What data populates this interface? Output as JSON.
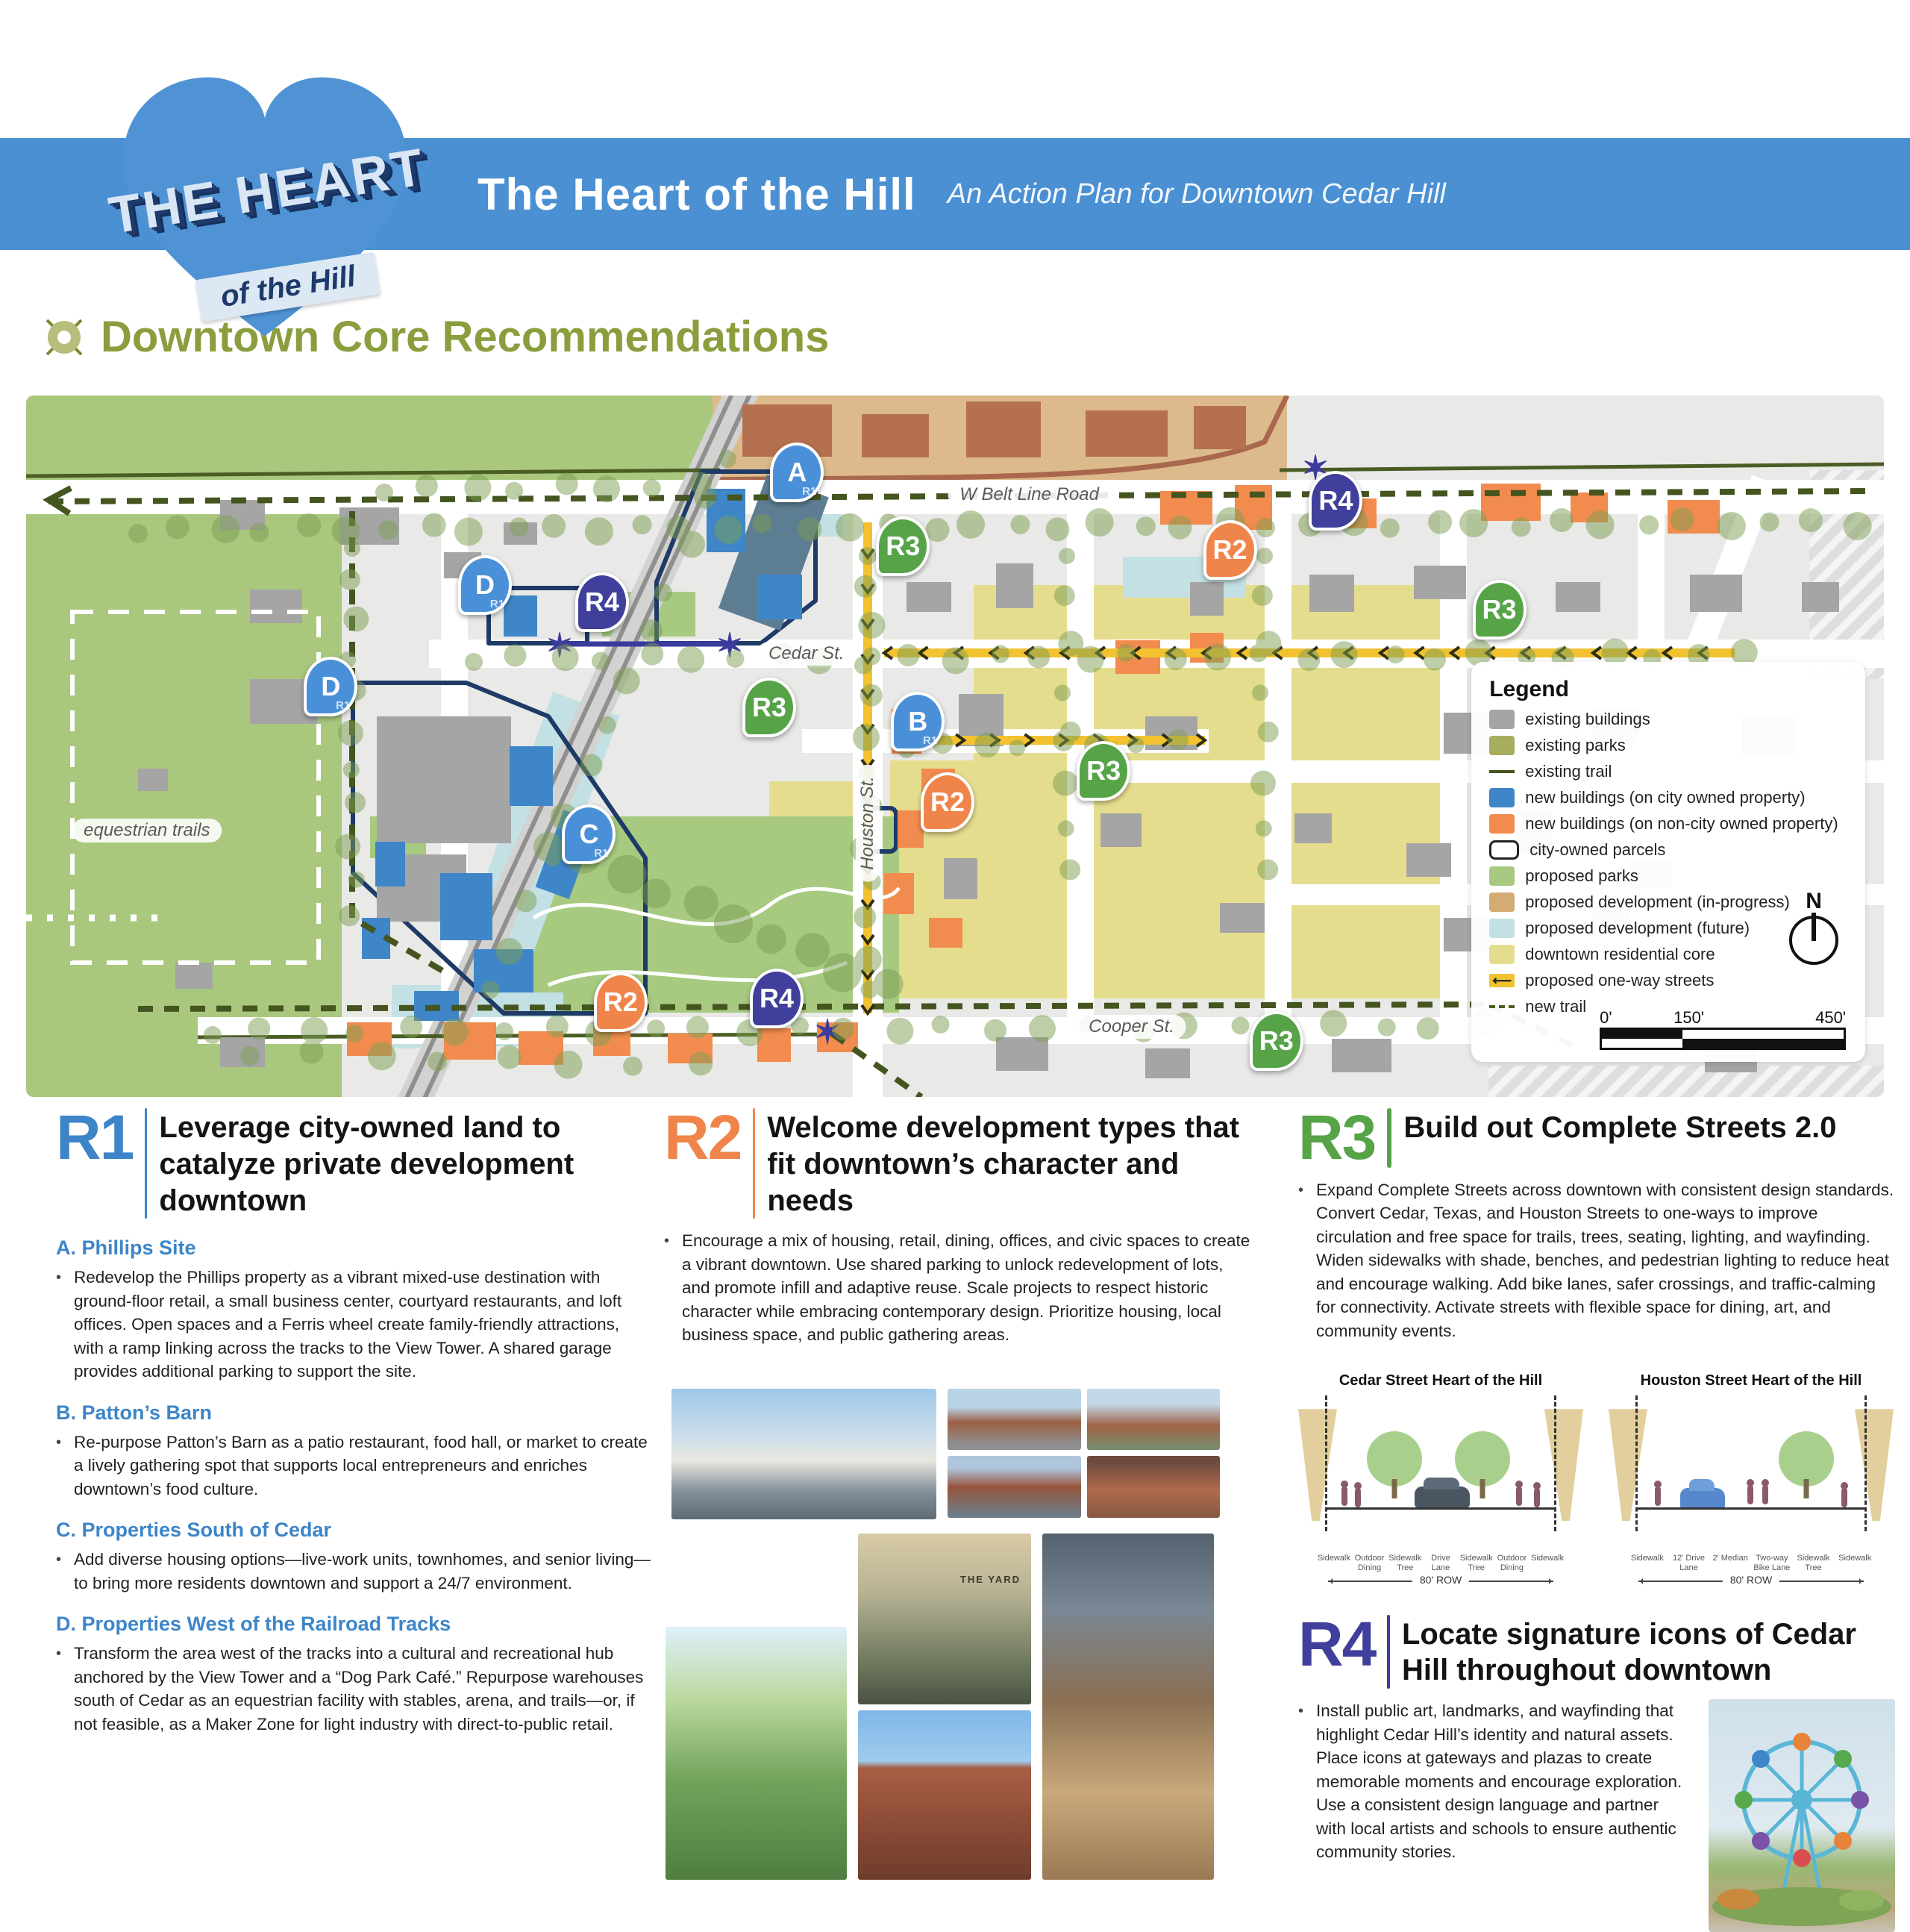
{
  "header": {
    "logo_line1": "THE HEART",
    "logo_line2": "of the Hill",
    "title": "The Heart of the Hill",
    "subtitle": "An Action Plan for Downtown Cedar Hill"
  },
  "section_title": "Downtown Core Recommendations",
  "map": {
    "street_labels": {
      "belt_line": "W Belt Line Road",
      "cedar": "Cedar St.",
      "houston": "Houston St.",
      "cooper": "Cooper St."
    },
    "area_labels": {
      "equestrian": "equestrian trails"
    },
    "badges": [
      {
        "label": "A",
        "sub": "R1"
      },
      {
        "label": "R4"
      },
      {
        "label": "R3"
      },
      {
        "label": "R2"
      },
      {
        "label": "R3"
      },
      {
        "label": "D",
        "sub": "R1"
      },
      {
        "label": "R4"
      },
      {
        "label": "D",
        "sub": "R1"
      },
      {
        "label": "R3"
      },
      {
        "label": "B",
        "sub": "R1"
      },
      {
        "label": "R3"
      },
      {
        "label": "R2"
      },
      {
        "label": "C",
        "sub": "R1"
      },
      {
        "label": "R2"
      },
      {
        "label": "R4"
      },
      {
        "label": "R3"
      }
    ],
    "legend": {
      "title": "Legend",
      "items": [
        {
          "label": "existing buildings"
        },
        {
          "label": "existing parks"
        },
        {
          "label": "existing trail"
        },
        {
          "label": "new buildings (on city owned property)"
        },
        {
          "label": "new buildings (on non-city owned property)"
        },
        {
          "label": "city-owned parcels"
        },
        {
          "label": "proposed parks"
        },
        {
          "label": "proposed development (in-progress)"
        },
        {
          "label": "proposed development (future)"
        },
        {
          "label": "downtown residential core"
        },
        {
          "label": "proposed one-way streets"
        },
        {
          "label": "new trail"
        }
      ],
      "north": "N",
      "scale_ticks": [
        "0'",
        "150'",
        "450'"
      ]
    }
  },
  "recommendations": [
    {
      "id": "R1",
      "title": "Leverage city-owned land to catalyze private development downtown",
      "subsections": [
        {
          "heading": "A. Phillips Site",
          "bullet": "Redevelop the Phillips property as a vibrant mixed-use destination with ground-floor retail, a small business center, courtyard restaurants, and loft offices. Open spaces and a Ferris wheel create family-friendly attractions, with a ramp linking across the tracks to the View Tower. A shared garage provides additional parking to support the site."
        },
        {
          "heading": "B. Patton’s Barn",
          "bullet": "Re-purpose Patton’s Barn as a patio restaurant, food hall, or market to create a lively gathering spot that supports local entrepreneurs and enriches downtown’s food culture."
        },
        {
          "heading": "C. Properties South of Cedar",
          "bullet": "Add diverse housing options—live-work units, townhomes, and senior living—to bring more residents downtown and support a 24/7 environment."
        },
        {
          "heading": "D. Properties West of the Railroad Tracks",
          "bullet": "Transform the area west of the tracks into a cultural and recreational hub anchored by the View Tower and a “Dog Park Café.” Repurpose warehouses south of Cedar as an equestrian facility with stables, arena, and trails—or, if not feasible, as a Maker Zone for light industry with direct-to-public retail."
        }
      ]
    },
    {
      "id": "R2",
      "title": "Welcome development types that fit downtown’s character and needs",
      "bullet": "Encourage a mix of housing, retail, dining, offices, and civic spaces to create a vibrant downtown. Use shared parking to unlock redevelopment of lots, and promote infill and adaptive reuse. Scale projects to respect historic character while embracing contemporary design. Prioritize housing, local business space, and public gathering areas."
    },
    {
      "id": "R3",
      "title": "Build out Complete Streets 2.0",
      "bullet": "Expand Complete Streets across downtown with consistent design standards. Convert Cedar, Texas, and Houston Streets to one-ways to improve circulation and free space for trails, trees, seating, lighting, and wayfinding. Widen sidewalks with shade, benches, and pedestrian lighting to reduce heat and encourage walking. Add bike lanes, safer crossings, and traffic-calming for connectivity. Activate streets with flexible space for dining, art, and community events.",
      "diagrams": [
        {
          "title": "Cedar Street Heart of the Hill",
          "row": "80' ROW",
          "labels": [
            "Sidewalk",
            "Outdoor Dining",
            "Sidewalk Tree",
            "Drive Lane",
            "Sidewalk Tree",
            "Outdoor Dining",
            "Sidewalk"
          ]
        },
        {
          "title": "Houston Street Heart of the Hill",
          "row": "80' ROW",
          "labels": [
            "Sidewalk",
            "12' Drive Lane",
            "2' Median",
            "Two-way Bike Lane",
            "Sidewalk Tree",
            "Sidewalk"
          ]
        }
      ]
    },
    {
      "id": "R4",
      "title": "Locate signature icons of Cedar Hill throughout downtown",
      "bullet": "Install public art, landmarks, and wayfinding that highlight Cedar Hill’s identity and natural assets. Place icons at gateways and plazas to create memorable moments and encourage exploration. Use a consistent design language and partner with local artists and schools to ensure authentic community stories."
    }
  ],
  "photos": {
    "yard_sign": "THE YARD"
  }
}
